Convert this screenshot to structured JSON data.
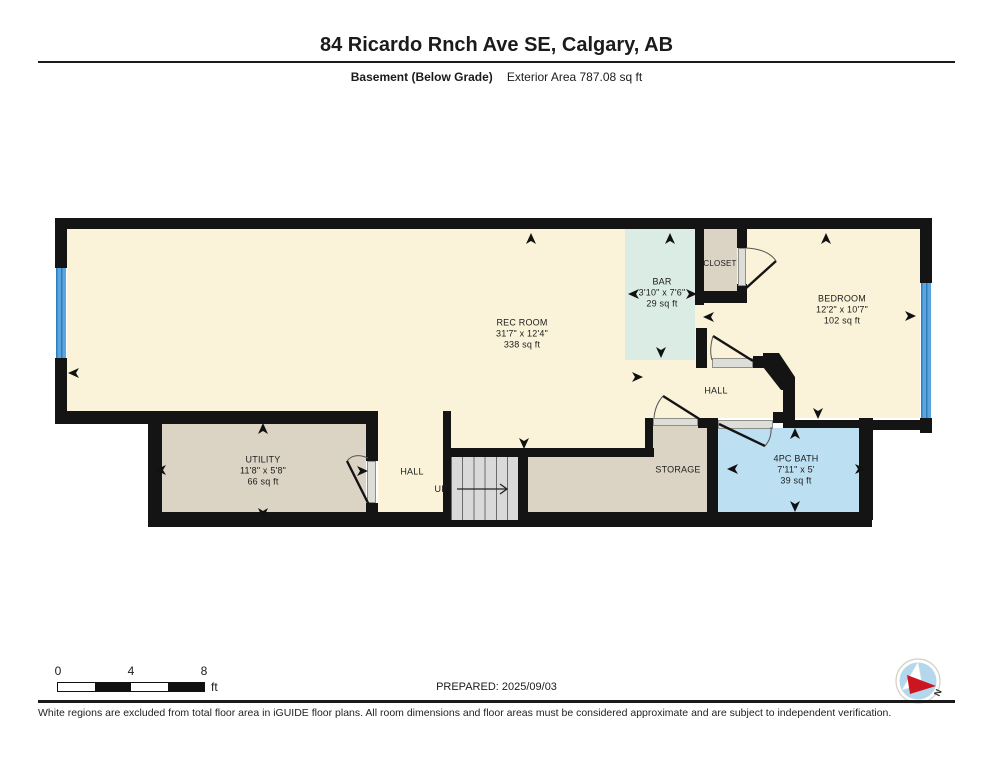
{
  "header": {
    "title": "84 Ricardo Rnch Ave SE, Calgary, AB",
    "floor_label": "Basement (Below Grade)",
    "area_label": "Exterior Area 787.08 sq ft"
  },
  "rooms": {
    "rec": {
      "name": "REC ROOM",
      "dims": "31'7\" x 12'4\"",
      "area": "338 sq ft"
    },
    "bar": {
      "name": "BAR",
      "dims": "3'10\" x 7'6\"",
      "area": "29 sq ft"
    },
    "closet": {
      "name": "CLOSET"
    },
    "bedroom": {
      "name": "BEDROOM",
      "dims": "12'2\" x 10'7\"",
      "area": "102 sq ft"
    },
    "hall_upper": {
      "name": "HALL"
    },
    "utility": {
      "name": "UTILITY",
      "dims": "11'8\" x 5'8\"",
      "area": "66 sq ft"
    },
    "hall_lower": {
      "name": "HALL"
    },
    "storage": {
      "name": "STORAGE"
    },
    "bath": {
      "name": "4PC BATH",
      "dims": "7'11\" x 5'",
      "area": "39 sq ft"
    },
    "stairs": {
      "up_label": "UP"
    }
  },
  "footer": {
    "scale": {
      "t0": "0",
      "t1": "4",
      "t2": "8",
      "unit": "ft"
    },
    "prepared": "PREPARED: 2025/09/03",
    "compass_n": "N",
    "disclaimer": "White regions are excluded from total floor area in iGUIDE floor plans. All room dimensions and floor areas must be considered approximate and are subject to independent verification."
  },
  "colors": {
    "wall": "#141414",
    "room_cream": "#FAF3D9",
    "bar_teal": "#DBECE5",
    "storage_beige": "#DBD3C4",
    "bath_blue": "#BDDFF2",
    "window_blue": "#4D9AD5",
    "stairs_gray": "#D9D9D9",
    "sill_gray": "#DEDED9"
  }
}
